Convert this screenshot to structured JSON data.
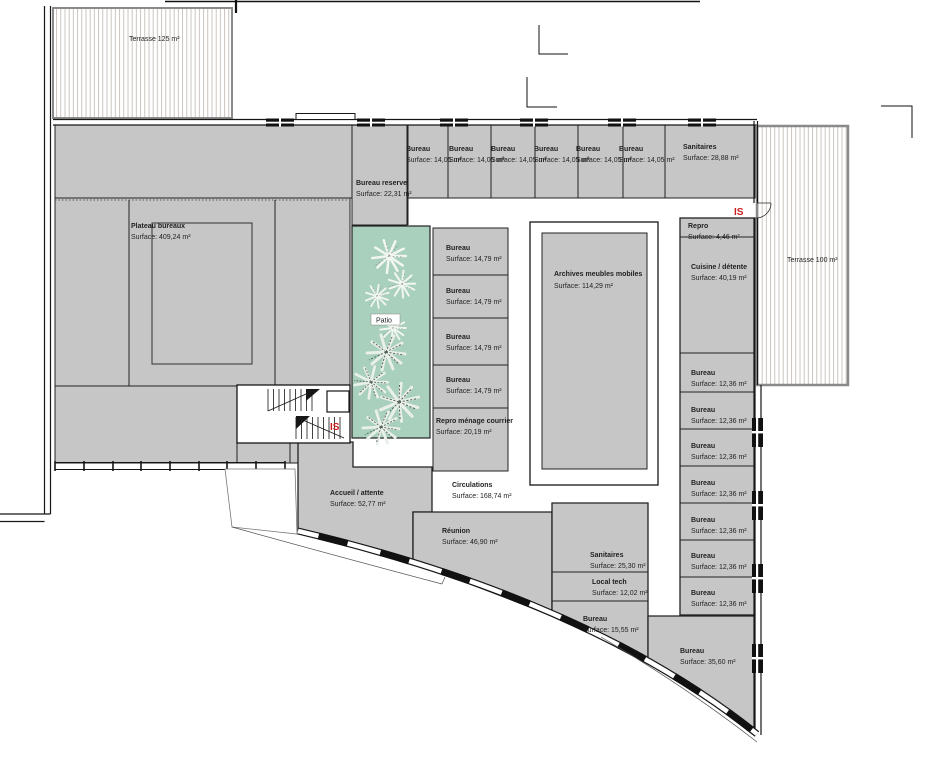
{
  "plan": {
    "markers": {
      "is": "IS",
      "patio": "Patio"
    },
    "terraces": {
      "northwest": "Terrasse 125 m²",
      "east": "Terrasse 100 m²"
    },
    "rooms": {
      "plateau_bureaux": {
        "name": "Plateau bureaux",
        "surface": "Surface: 409,24 m²"
      },
      "bureau_reserve": {
        "name": "Bureau reserve",
        "surface": "Surface: 22,31 m²"
      },
      "bureau_1405": {
        "name": "Bureau",
        "surface": "Surface: 14,05 m²"
      },
      "sanitaires_nord": {
        "name": "Sanitaires",
        "surface": "Surface: 28,88 m²"
      },
      "repro": {
        "name": "Repro",
        "surface": "Surface: 4,46 m²"
      },
      "cuisine_detente": {
        "name": "Cuisine / détente",
        "surface": "Surface: 40,19 m²"
      },
      "bureau_1479": {
        "name": "Bureau",
        "surface": "Surface: 14,79 m²"
      },
      "repro_menage_courrier": {
        "name": "Repro ménage courrier",
        "surface": "Surface: 20,19 m²"
      },
      "archives": {
        "name": "Archives meubles mobiles",
        "surface": "Surface: 114,29 m²"
      },
      "bureau_1236": {
        "name": "Bureau",
        "surface": "Surface: 12,36 m²"
      },
      "accueil_attente": {
        "name": "Accueil / attente",
        "surface": "Surface: 52,77 m²"
      },
      "circulations": {
        "name": "Circulations",
        "surface": "Surface: 168,74 m²"
      },
      "reunion": {
        "name": "Réunion",
        "surface": "Surface: 46,90 m²"
      },
      "sanitaires_sud": {
        "name": "Sanitaires",
        "surface": "Surface: 25,30 m²"
      },
      "local_tech": {
        "name": "Local tech",
        "surface": "Surface: 12,02 m²"
      },
      "bureau_1555": {
        "name": "Bureau",
        "surface": "Surface: 15,55 m²"
      },
      "bureau_3560": {
        "name": "Bureau",
        "surface": "Surface: 35,60 m²"
      }
    },
    "colors": {
      "room_fill": "#c6c6c6",
      "patio_fill": "#a9cfbd",
      "hatch_line": "#c0b4ac",
      "marker_red": "#c81e1e",
      "wall": "#161616"
    }
  }
}
